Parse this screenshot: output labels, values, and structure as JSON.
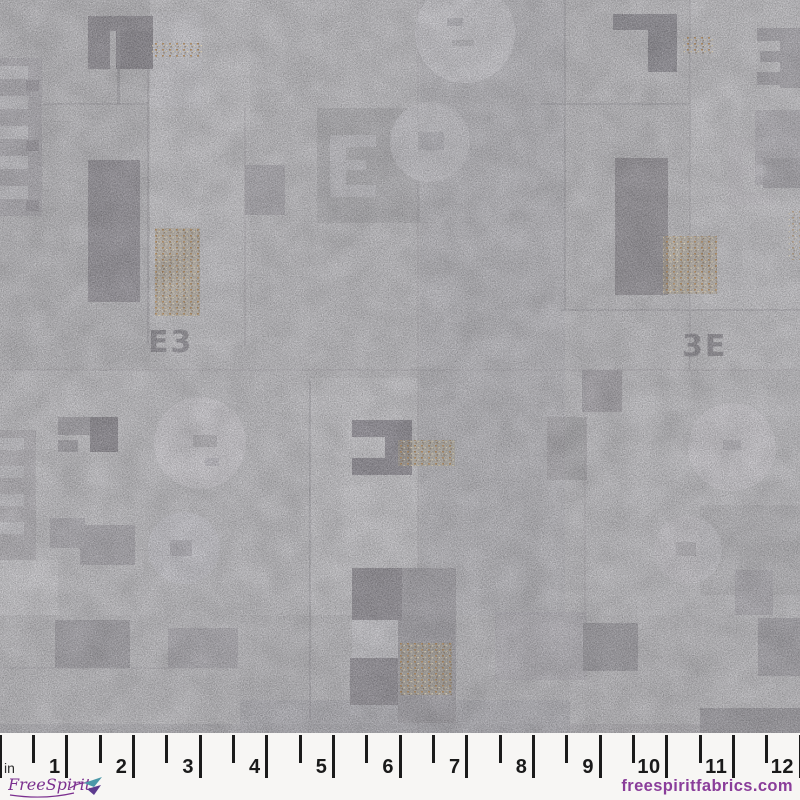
{
  "image": {
    "description": "Gray abstract grunge patchwork fabric swatch with stamped letter shapes over a printed inch ruler"
  },
  "fabric": {
    "letter_marks": {
      "left": "E3",
      "right": "3E"
    },
    "palette": {
      "base": "#c3c2c6",
      "light": "#cfced3",
      "medium": "#aaa8ae",
      "dark": "#96939a",
      "tan_accent": "#b98c56"
    }
  },
  "ruler": {
    "unit_label": "in",
    "inches_visible": 12,
    "numbers": [
      "1",
      "2",
      "3",
      "4",
      "5",
      "6",
      "7",
      "8",
      "9",
      "10",
      "11",
      "12"
    ],
    "tick_color": "#1b1b1b",
    "number_color": "#1a1a1a",
    "background": "#f7f6f4"
  },
  "branding": {
    "logo_text": "FreeSpirit",
    "logo_color": "#7b2f8f",
    "website": "freespiritfabrics.com",
    "website_color": "#8a3d9a"
  }
}
